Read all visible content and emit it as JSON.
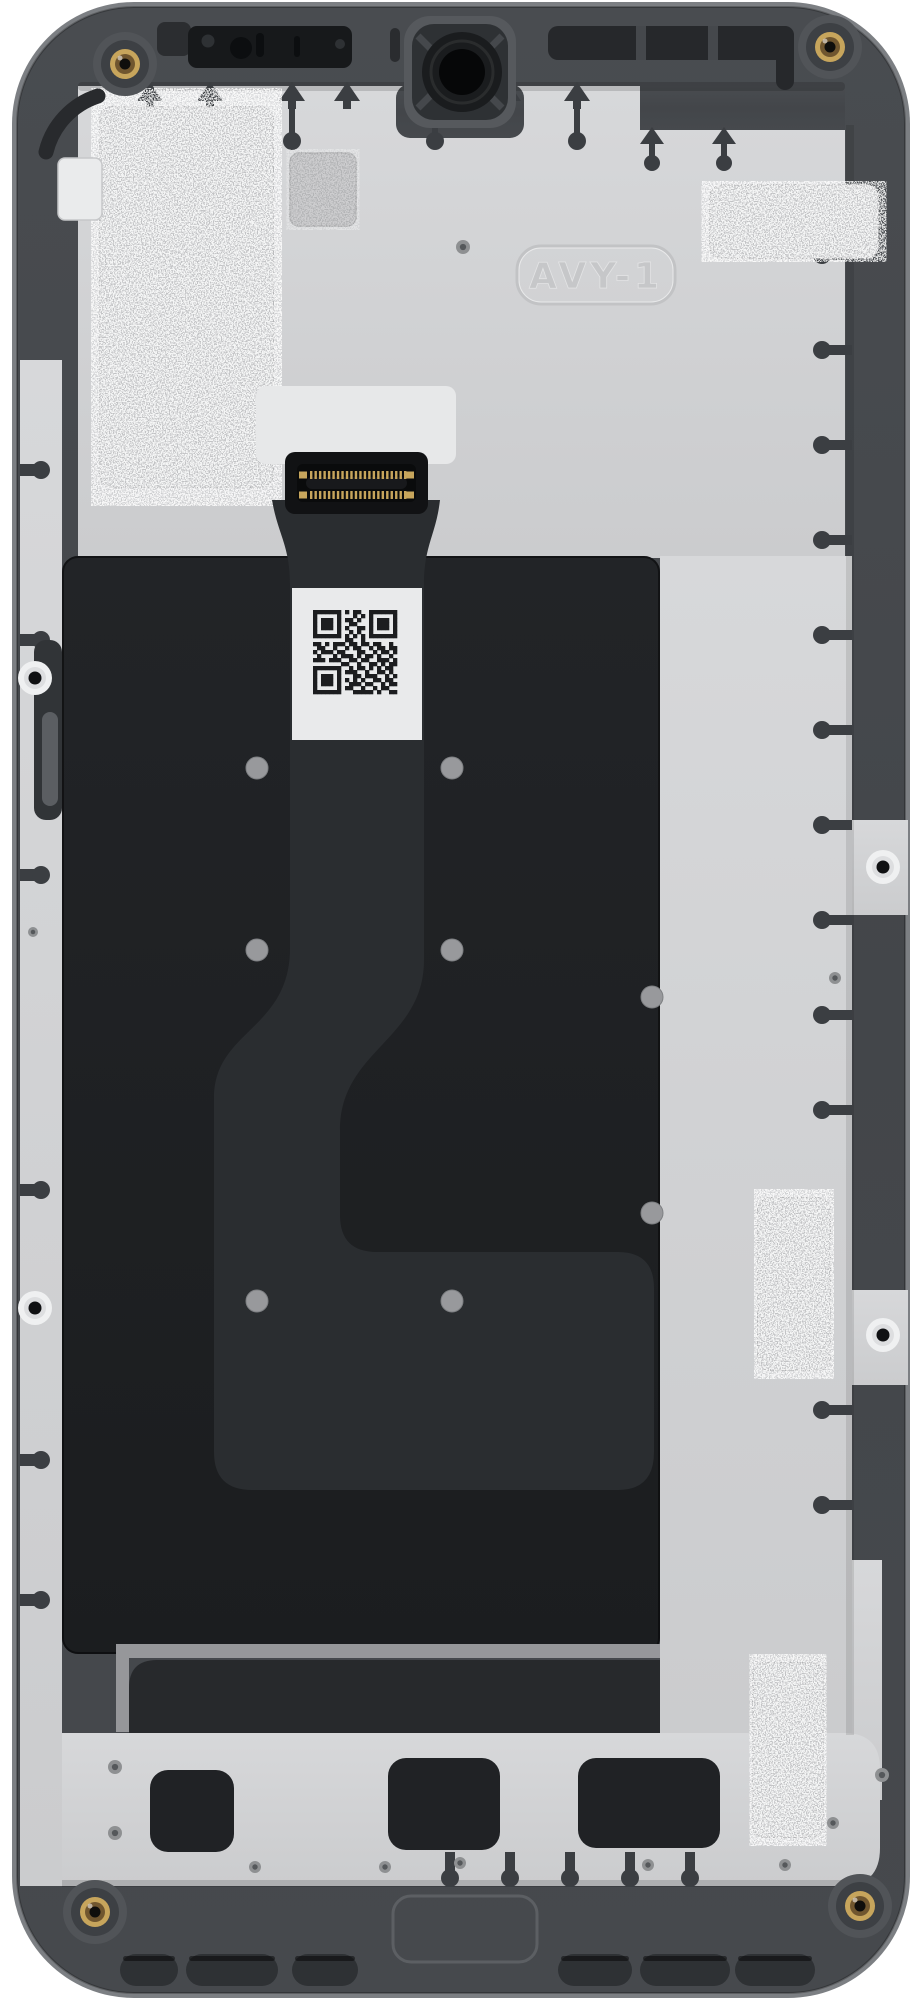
{
  "part": {
    "embossed_label": "AVY-1"
  },
  "colors": {
    "background": "#ffffff",
    "frame": "#45484c",
    "frame_edge_highlight": "#85888c",
    "frame_recess": "#26282b",
    "back_plate": "#d2d3d5",
    "display_panel": "#1e2023",
    "flex_cable": "#2a2d30",
    "foil_pad": "#c2c3c5",
    "metal_pad": "#b2b3b5",
    "metal_strip": "#96979a",
    "qr_label_bg": "#e9eaeb",
    "qr_module": "#1c1d1f",
    "brass_screw": "#c7a55c",
    "panel_dot": "#98999c",
    "grommet": "#eff0f1",
    "tab_cutout": "#3b3e42"
  },
  "qr_pattern": [
    "111111101011001111111",
    "100000100010101000001",
    "101110101101001011101",
    "101110100110001011101",
    "101110101001101011101",
    "100000100101001000001",
    "111111101010101111111",
    "000000001100100000000",
    "110101110110110110010",
    "011001001011001011011",
    "101110110001100101101",
    "010001011101011010010",
    "111011100110110011101",
    "000000011001001101011",
    "111111100101101010110",
    "100000101110010011010",
    "101110100011011100101",
    "101110101010100110110",
    "101110100111011001011",
    "100000101100100101100",
    "111111100011111010011"
  ],
  "panel_dots": [
    [
      257,
      768
    ],
    [
      452,
      768
    ],
    [
      257,
      950
    ],
    [
      452,
      950
    ],
    [
      652,
      997
    ],
    [
      652,
      1213
    ],
    [
      257,
      1301
    ],
    [
      452,
      1301
    ]
  ],
  "screw_bosses": [
    [
      125,
      64
    ],
    [
      830,
      47
    ],
    [
      95,
      1912
    ],
    [
      860,
      1906
    ]
  ],
  "grommets": [
    [
      35,
      678
    ],
    [
      35,
      1308
    ],
    [
      883,
      867
    ],
    [
      883,
      1335
    ]
  ],
  "small_holes": [
    [
      463,
      247,
      7
    ],
    [
      835,
      978,
      6
    ],
    [
      33,
      932,
      5
    ],
    [
      882,
      1775,
      7
    ],
    [
      115,
      1767,
      7
    ],
    [
      115,
      1833,
      7
    ],
    [
      255,
      1867,
      6
    ],
    [
      385,
      1867,
      6
    ],
    [
      460,
      1863,
      6
    ],
    [
      648,
      1865,
      6
    ],
    [
      785,
      1865,
      6
    ],
    [
      833,
      1823,
      6
    ]
  ],
  "foil_pads": [
    [
      100,
      107,
      173,
      380
    ],
    [
      710,
      185,
      168,
      73
    ],
    [
      758,
      1198,
      72,
      172
    ],
    [
      753,
      1663,
      70,
      174
    ]
  ],
  "small_metal_pad": [
    290,
    153,
    66,
    73
  ],
  "tabs": {
    "top_arrows": [
      150,
      210,
      292,
      347,
      435,
      508,
      577
    ],
    "top_drops": [
      292,
      435,
      577
    ],
    "low_arrows": [
      652,
      724
    ],
    "left_mushrooms": [
      470,
      640,
      875,
      1190,
      1460,
      1600
    ],
    "right_mushrooms": [
      255,
      350,
      445,
      540,
      635,
      730,
      825,
      920,
      1015,
      1110,
      1410,
      1505
    ],
    "bottom_mushrooms": [
      450,
      510,
      570,
      630,
      690
    ]
  },
  "bottom_slots": [
    [
      120,
      1954,
      58,
      32
    ],
    [
      186,
      1954,
      92,
      32
    ],
    [
      292,
      1954,
      66,
      32
    ],
    [
      558,
      1954,
      74,
      32
    ],
    [
      640,
      1954,
      90,
      32
    ],
    [
      735,
      1954,
      80,
      32
    ]
  ],
  "bottom_cutouts": [
    [
      150,
      1770,
      84,
      82
    ],
    [
      388,
      1758,
      112,
      92
    ],
    [
      578,
      1758,
      142,
      90
    ]
  ],
  "connector": {
    "pin_count": 22
  }
}
